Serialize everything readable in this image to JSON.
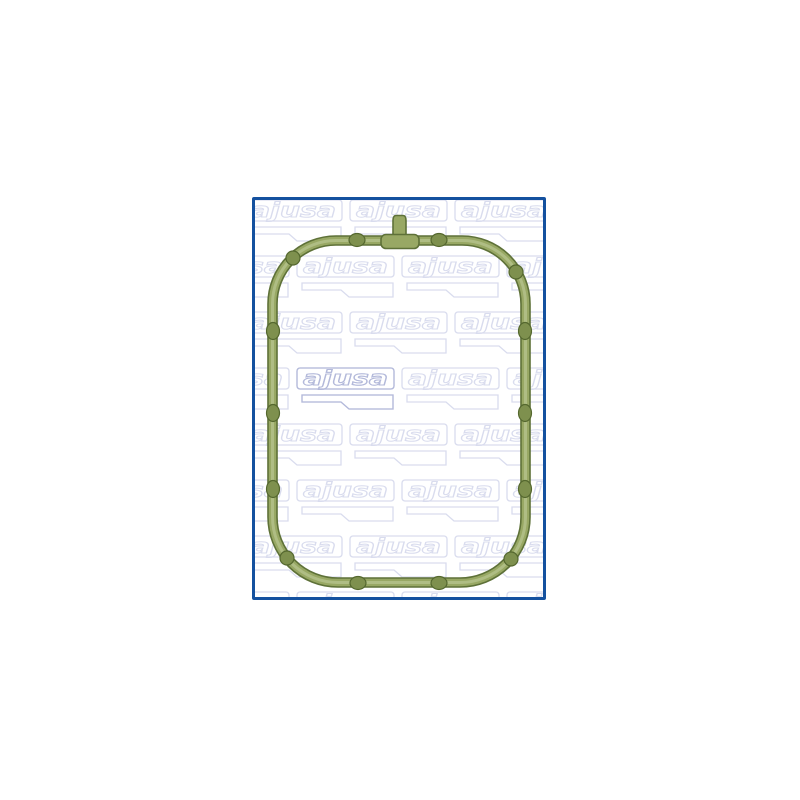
{
  "page": {
    "background": "#ffffff"
  },
  "product_image": {
    "brand": "ajusa",
    "watermark_text": "ajusa",
    "subject": "green intake manifold gasket",
    "colors": {
      "frame_border": "#14519f",
      "watermark": "#d9dcee",
      "watermark_emphasis": "#b3b9da",
      "gasket_fill": "#98a864",
      "gasket_edge": "#5e7138",
      "gasket_highlight": "#bcc795",
      "gasket_bump": "#7e904e",
      "gasket_bump_edge": "#55682f",
      "background": "#ffffff"
    }
  }
}
